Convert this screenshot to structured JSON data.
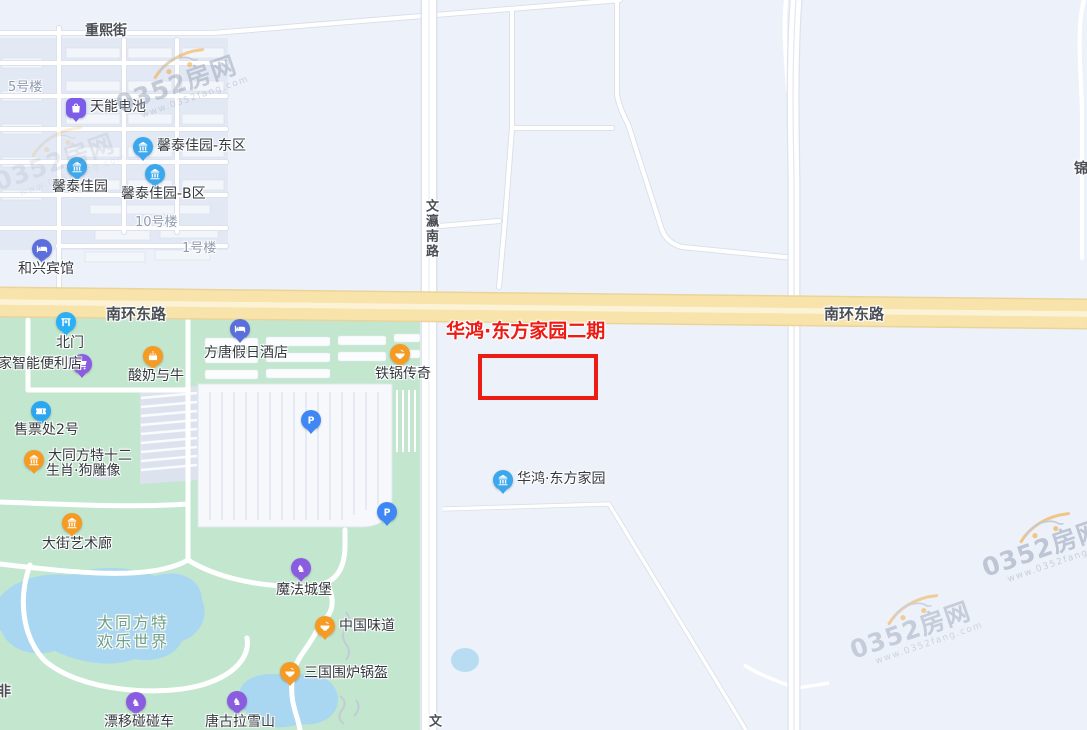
{
  "colors": {
    "map_bg": "#EDF1F9",
    "block": "#E2E8F4",
    "park_green": "#C3E6CF",
    "water": "#A9D6F0",
    "major_road": "#F8E3AA",
    "highlight_red": "#EC1B13",
    "pin_blue": "#3BA7EC",
    "pin_lightblue": "#2BB0F5",
    "pin_indigo": "#5A6FDC",
    "pin_purple": "#8A5CE0",
    "pin_orange": "#F59A23",
    "pin_parking": "#3F87F5"
  },
  "road_labels": [
    {
      "text": "重熙街",
      "x": 85,
      "y": 20,
      "fs": 14
    },
    {
      "text": "南环东路",
      "x": 106,
      "y": 303,
      "fs": 15
    },
    {
      "text": "南环东路",
      "x": 824,
      "y": 303,
      "fs": 15
    },
    {
      "text": "文瀛南路",
      "x": 421,
      "y": 199,
      "fs": 13,
      "vertical": true
    },
    {
      "text": "文",
      "x": 424,
      "y": 714,
      "fs": 13,
      "vertical": true
    },
    {
      "text": "锦",
      "x": 1074,
      "y": 158,
      "fs": 14
    },
    {
      "text": "非",
      "x": -3,
      "y": 681,
      "fs": 14
    }
  ],
  "building_labels": [
    {
      "text": "5号楼",
      "x": 8,
      "y": 76
    },
    {
      "text": "10号楼",
      "x": 135,
      "y": 211
    },
    {
      "text": "1号楼",
      "x": 182,
      "y": 237
    }
  ],
  "park_label": {
    "lines": [
      "大同方特",
      "欢乐世界"
    ],
    "x": 97,
    "y": 613
  },
  "pois": [
    {
      "label": "天能电池",
      "glyph": "bag",
      "shape": "squircle",
      "color": "#7C5CE8",
      "x": 76,
      "y": 108,
      "lx": 90,
      "ly": 100
    },
    {
      "label": "馨泰佳园-东区",
      "glyph": "building",
      "color": "#3BA7EC",
      "x": 143,
      "y": 147,
      "lx": 157,
      "ly": 139
    },
    {
      "label": "馨泰佳园",
      "glyph": "building",
      "color": "#3BA7EC",
      "x": 77,
      "y": 167,
      "lx": 52,
      "ly": 180
    },
    {
      "label": "馨泰佳园-B区",
      "glyph": "building",
      "color": "#3BA7EC",
      "x": 155,
      "y": 174,
      "lx": 121,
      "ly": 187
    },
    {
      "label": "和兴宾馆",
      "glyph": "bed",
      "color": "#5A6FDC",
      "x": 42,
      "y": 249,
      "lx": 18,
      "ly": 262
    },
    {
      "label": "北门",
      "glyph": "gate",
      "color": "#2BB0F5",
      "x": 66,
      "y": 322,
      "lx": 56,
      "ly": 336
    },
    {
      "label": "家智能便利店",
      "glyph": "cart",
      "color": "#8A5CE0",
      "x": 82,
      "y": 364,
      "lx": -2,
      "ly": 357
    },
    {
      "label": "方唐假日酒店",
      "glyph": "bed",
      "color": "#5A6FDC",
      "x": 240,
      "y": 329,
      "lx": 204,
      "ly": 346
    },
    {
      "label": "酸奶与牛",
      "glyph": "cake",
      "color": "#F59A23",
      "x": 153,
      "y": 356,
      "lx": 128,
      "ly": 369
    },
    {
      "label": "铁锅传奇",
      "glyph": "bowl",
      "color": "#F59A23",
      "x": 400,
      "y": 354,
      "lx": 375,
      "ly": 367
    },
    {
      "label": "售票处2号",
      "glyph": "ticket",
      "color": "#2BA6F0",
      "x": 41,
      "y": 411,
      "lx": 14,
      "ly": 423
    },
    {
      "label": "大同方特十二",
      "label2": "生肖·狗雕像",
      "glyph": "building",
      "color": "#F59A23",
      "x": 34,
      "y": 460,
      "lx": 48,
      "ly": 449,
      "l2x": 46,
      "l2y": 464
    },
    {
      "label": "大街艺术廊",
      "glyph": "building",
      "color": "#F59A23",
      "x": 72,
      "y": 523,
      "lx": 42,
      "ly": 537
    },
    {
      "label": "P",
      "glyph": "p",
      "color": "#3F87F5",
      "x": 311,
      "y": 420
    },
    {
      "label": "P",
      "glyph": "p",
      "color": "#3F87F5",
      "x": 387,
      "y": 512
    },
    {
      "label": "魔法城堡",
      "glyph": "horse",
      "color": "#8A5CE0",
      "x": 301,
      "y": 568,
      "lx": 276,
      "ly": 583
    },
    {
      "label": "中国味道",
      "glyph": "bowl",
      "color": "#F59A23",
      "x": 325,
      "y": 626,
      "lx": 339,
      "ly": 619
    },
    {
      "label": "三国围炉锅盔",
      "glyph": "bowl",
      "color": "#F59A23",
      "x": 290,
      "y": 672,
      "lx": 304,
      "ly": 666
    },
    {
      "label": "漂移碰碰车",
      "glyph": "horse",
      "color": "#8A5CE0",
      "x": 136,
      "y": 702,
      "lx": 104,
      "ly": 715
    },
    {
      "label": "唐古拉雪山",
      "glyph": "horse",
      "color": "#8A5CE0",
      "x": 237,
      "y": 701,
      "lx": 205,
      "ly": 715
    },
    {
      "label": "华鸿·东方家园",
      "glyph": "building",
      "color": "#3BA7EC",
      "x": 503,
      "y": 480,
      "lx": 517,
      "ly": 472
    }
  ],
  "highlight": {
    "title": "华鸿·东方家园二期",
    "title_x": 446,
    "title_y": 316,
    "title_fs": 19,
    "title_color": "#EC1B13",
    "rect": {
      "x": 478,
      "y": 354,
      "w": 112,
      "h": 38,
      "border": 4,
      "color": "#EC1B13"
    }
  },
  "watermark": {
    "brand": "0352房网",
    "site": "www.0352fang.com"
  }
}
